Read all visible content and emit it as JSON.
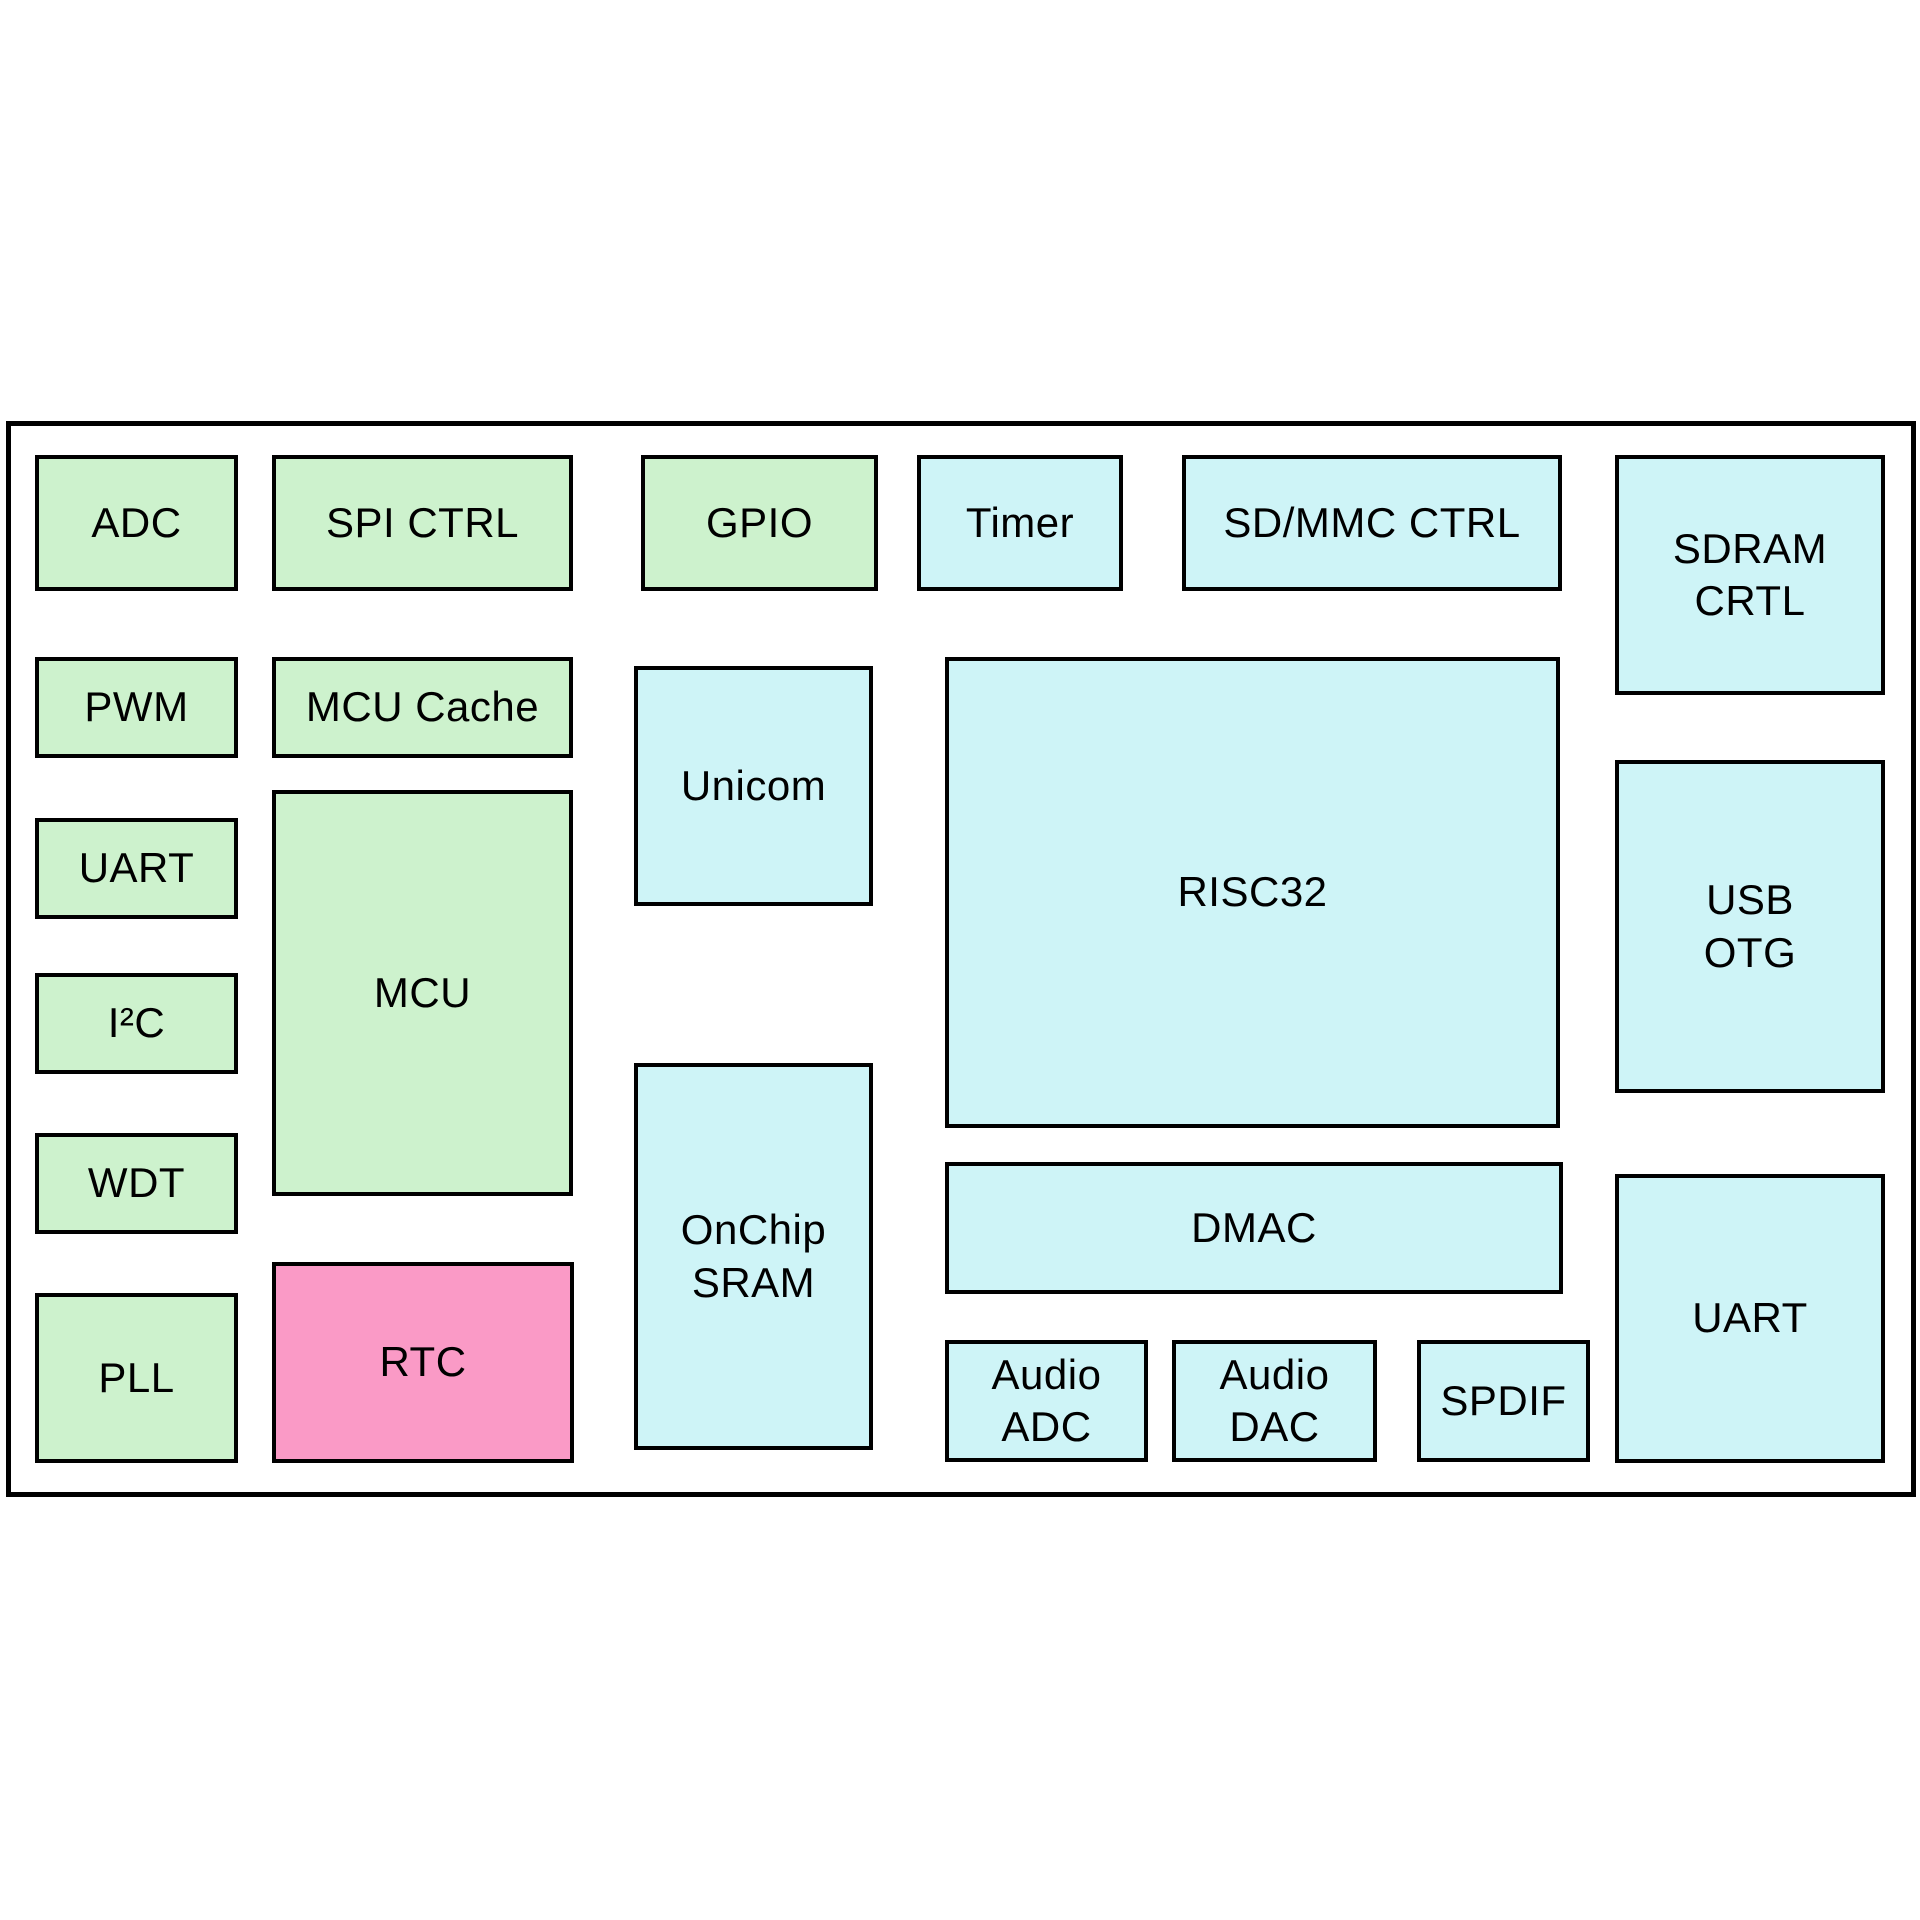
{
  "diagram": {
    "type": "soc-block-diagram",
    "palette": {
      "green": "#CDF2CD",
      "cyan": "#CEF4F7",
      "pink": "#FA9AC6",
      "border": "#000000",
      "background": "#FFFFFF"
    },
    "blocks": [
      {
        "id": "adc",
        "label": "ADC",
        "color": "green"
      },
      {
        "id": "spi-ctrl",
        "label": "SPI CTRL",
        "color": "green"
      },
      {
        "id": "gpio",
        "label": "GPIO",
        "color": "green"
      },
      {
        "id": "timer",
        "label": "Timer",
        "color": "cyan"
      },
      {
        "id": "sdmmc-ctrl",
        "label": "SD/MMC CTRL",
        "color": "cyan"
      },
      {
        "id": "sdram-crtl",
        "label": "SDRAM\nCRTL",
        "color": "cyan"
      },
      {
        "id": "pwm",
        "label": "PWM",
        "color": "green"
      },
      {
        "id": "mcu-cache",
        "label": "MCU Cache",
        "color": "green"
      },
      {
        "id": "unicom",
        "label": "Unicom",
        "color": "cyan"
      },
      {
        "id": "risc32",
        "label": "RISC32",
        "color": "cyan"
      },
      {
        "id": "usb-otg",
        "label": "USB\nOTG",
        "color": "cyan"
      },
      {
        "id": "uart-left",
        "label": "UART",
        "color": "green"
      },
      {
        "id": "mcu",
        "label": "MCU",
        "color": "green"
      },
      {
        "id": "i2c",
        "label": "I²C",
        "color": "green"
      },
      {
        "id": "wdt",
        "label": "WDT",
        "color": "green"
      },
      {
        "id": "onchip-sram",
        "label": "OnChip\nSRAM",
        "color": "cyan"
      },
      {
        "id": "dmac",
        "label": "DMAC",
        "color": "cyan"
      },
      {
        "id": "uart-right",
        "label": "UART",
        "color": "cyan"
      },
      {
        "id": "pll",
        "label": "PLL",
        "color": "green"
      },
      {
        "id": "rtc",
        "label": "RTC",
        "color": "pink"
      },
      {
        "id": "audio-adc",
        "label": "Audio\nADC",
        "color": "cyan"
      },
      {
        "id": "audio-dac",
        "label": "Audio\nDAC",
        "color": "cyan"
      },
      {
        "id": "spdif",
        "label": "SPDIF",
        "color": "cyan"
      }
    ]
  }
}
